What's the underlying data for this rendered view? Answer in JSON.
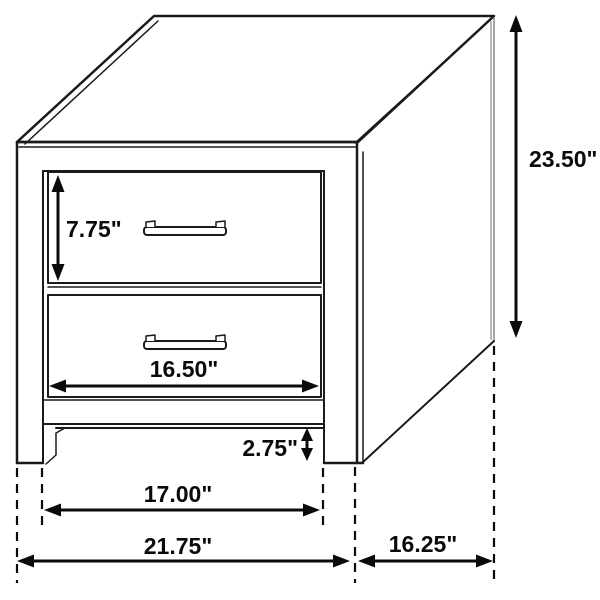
{
  "diagram": {
    "product": "two-drawer nightstand",
    "view": "isometric line drawing with dimension callouts",
    "unit": "inches",
    "colors": {
      "line": "#1a1a1a",
      "dimension": "#0a0a0a",
      "background": "#ffffff"
    },
    "labels": {
      "drawer_face_height": "7.75\"",
      "drawer_face_width": "16.50\"",
      "overall_height": "23.50\"",
      "base_clearance": "2.75\"",
      "inner_leg_width": "17.00\"",
      "overall_width": "21.75\"",
      "side_depth": "16.25\""
    },
    "dimension_values": {
      "drawer_face_height_in": 7.75,
      "drawer_face_width_in": 16.5,
      "overall_height_in": 23.5,
      "base_clearance_in": 2.75,
      "inner_leg_width_in": 17.0,
      "overall_width_in": 21.75,
      "side_depth_in": 16.25
    }
  }
}
